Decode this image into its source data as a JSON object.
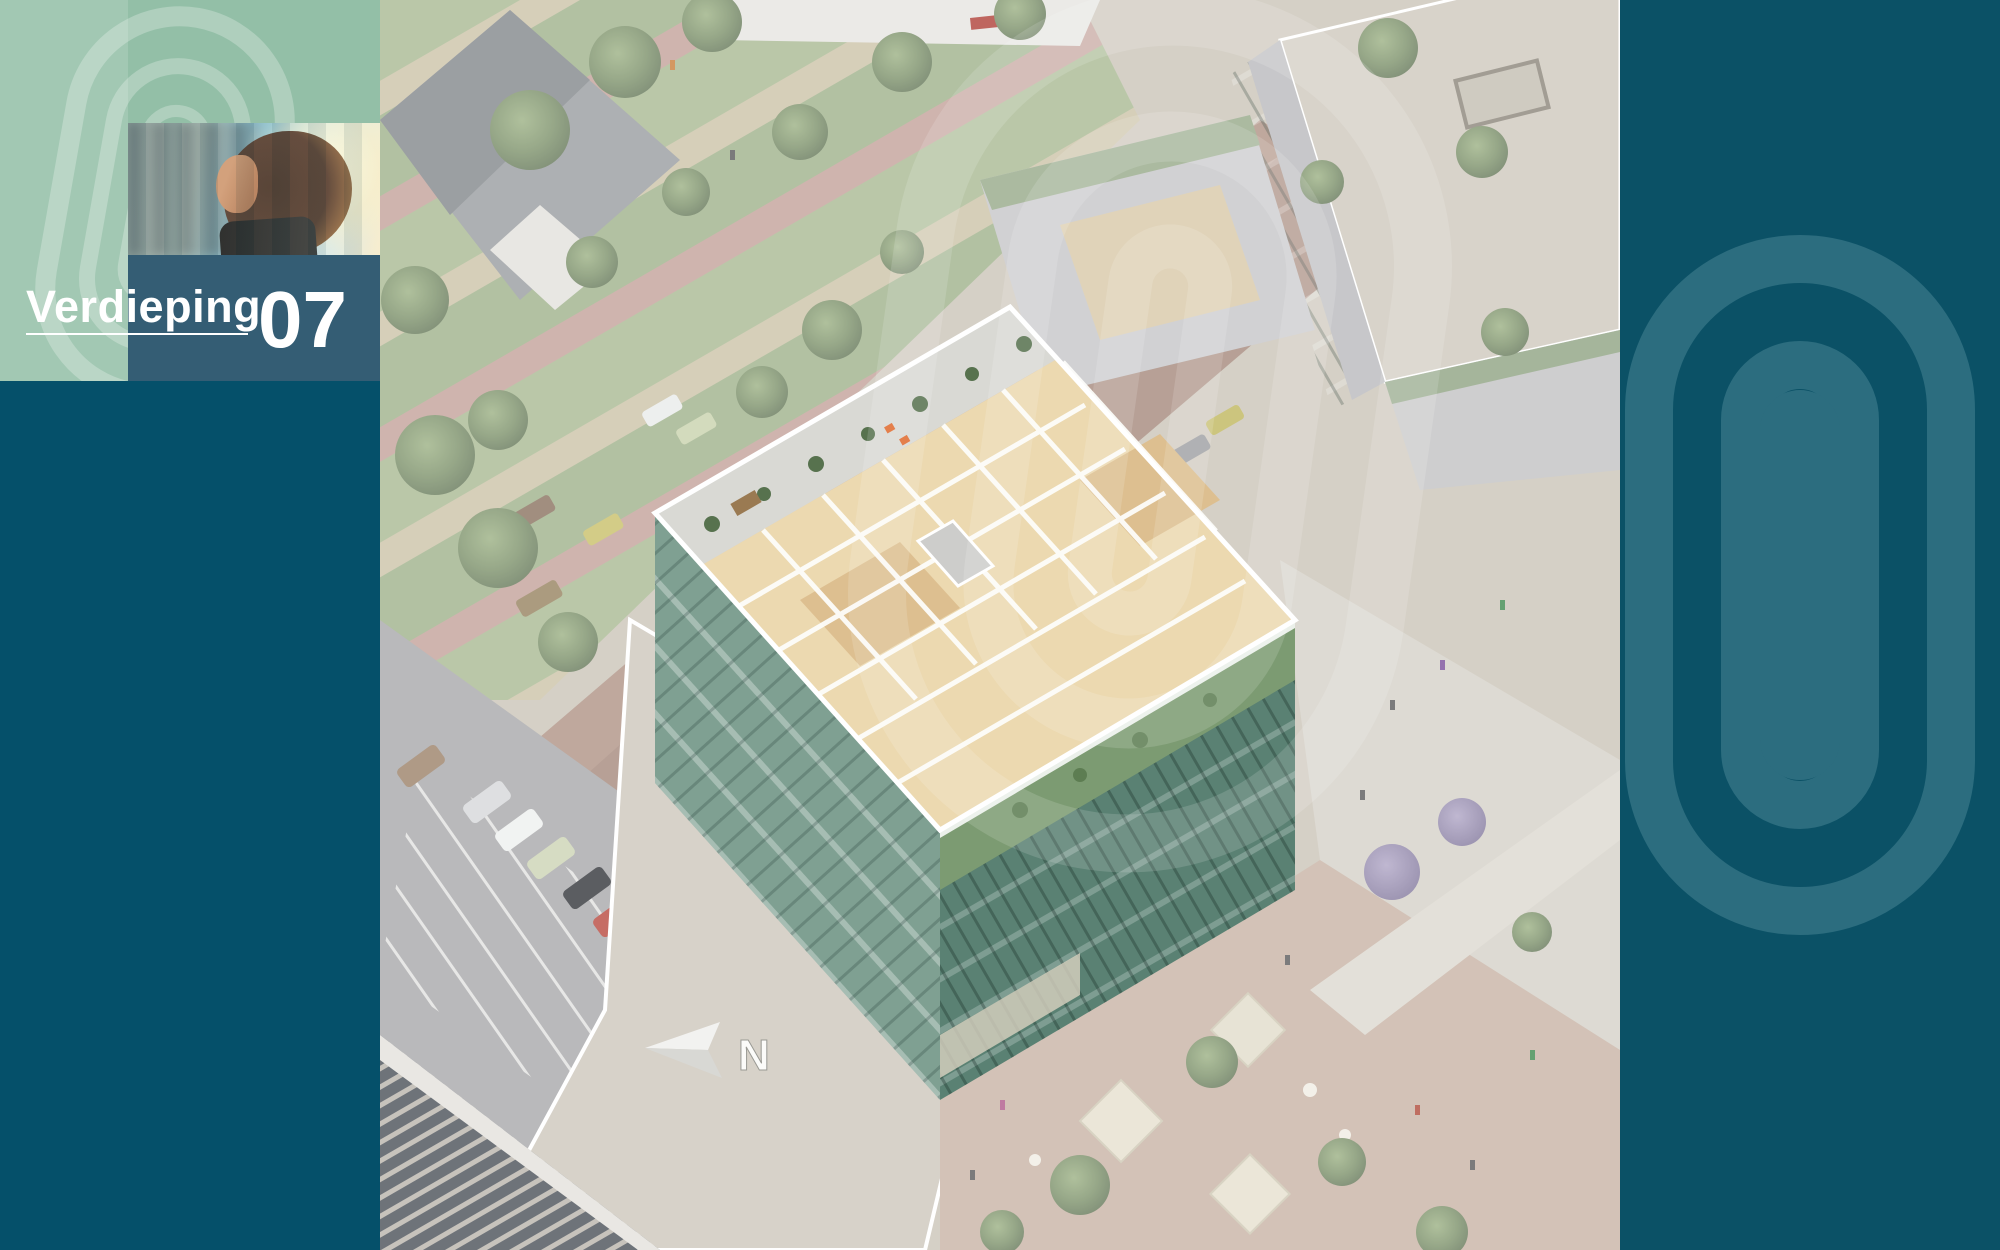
{
  "header": {
    "floor_label": "Verdieping",
    "floor_number": "07"
  },
  "map": {
    "compass_label": "N"
  },
  "icons": {
    "brand_watermark": "capsule-ring-logo",
    "compass": "north-arrow-icon"
  },
  "colors": {
    "sage-green": "#93bfa7",
    "label-teal": "#345d74",
    "dark-teal": "#05506a",
    "band-teal": "#0b5166",
    "band-watermark": "#2c6d7f",
    "roof-tan": "#ecd9b0",
    "facade-green-light": "#7fa092",
    "facade-green-dark": "#5a8173",
    "terrace-grey": "#d9d9d4",
    "accent-orange": "#e06a2e"
  }
}
